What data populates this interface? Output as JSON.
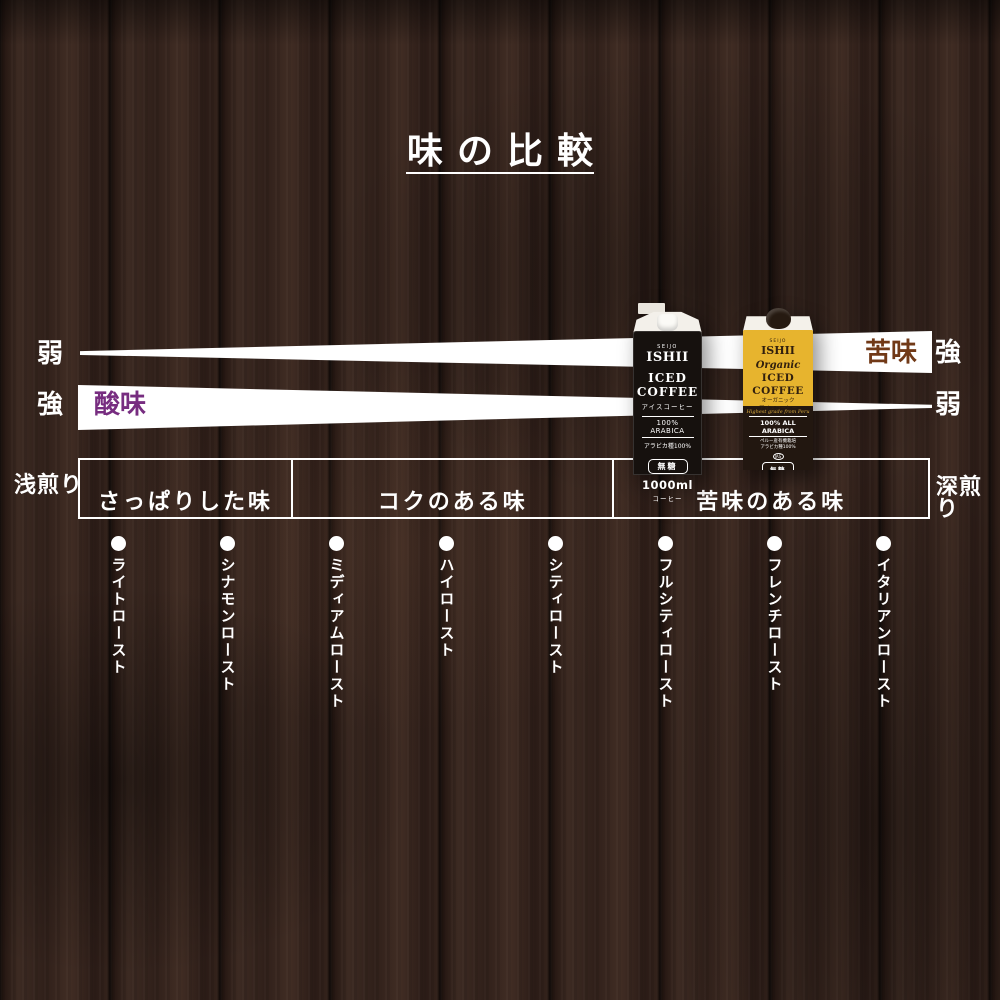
{
  "title": {
    "text": "味の比較"
  },
  "bands": {
    "bitterness": {
      "label": "苦味",
      "left_level": "弱",
      "right_level": "強",
      "label_color": "#713917"
    },
    "acidity": {
      "label": "酸味",
      "left_level": "強",
      "right_level": "弱",
      "label_color": "#772d80"
    }
  },
  "roast_scale": {
    "left_label": "浅煎り",
    "right_label": "深煎り",
    "sections": [
      {
        "label": "さっぱりした味"
      },
      {
        "label": "コクのある味"
      },
      {
        "label": "苦味のある味"
      }
    ],
    "roast_levels": [
      "ライトロースト",
      "シナモンロースト",
      "ミディアムロースト",
      "ハイロースト",
      "シティロースト",
      "フルシティロースト",
      "フレンチロースト",
      "イタリアンロースト"
    ]
  },
  "products": {
    "black_carton": {
      "brand_top": "SEIJO",
      "brand": "ISHII",
      "name_line1": "ICED",
      "name_line2": "COFFEE",
      "name_jp": "アイスコーヒー",
      "claim": "100% ARABICA",
      "claim_jp": "アラビカ種100%",
      "sugar": "無糖",
      "volume": "1000ml",
      "type_jp": "コーヒー"
    },
    "yellow_carton": {
      "brand_top": "SEIJO",
      "brand": "ISHII",
      "organic": "Organic",
      "name_line1": "ICED",
      "name_line2": "COFFEE",
      "name_jp1": "オーガニック",
      "name_jp2": "アイスコーヒー",
      "script": "Highest grade from Peru",
      "claim": "100% ALL ARABICA",
      "claim_jp1": "ペルー産有機栽培",
      "claim_jp2": "アラビカ種100%",
      "jas_mark": "JAS",
      "sugar": "無糖",
      "volume": "1000ml"
    }
  },
  "colors": {
    "background_wood": "#31211b",
    "band": "#ffffff",
    "text": "#ffffff",
    "bitterness_label": "#713917",
    "acidity_label": "#772d80",
    "yellow_carton": "#e7b42e",
    "black_carton": "#16110e"
  }
}
